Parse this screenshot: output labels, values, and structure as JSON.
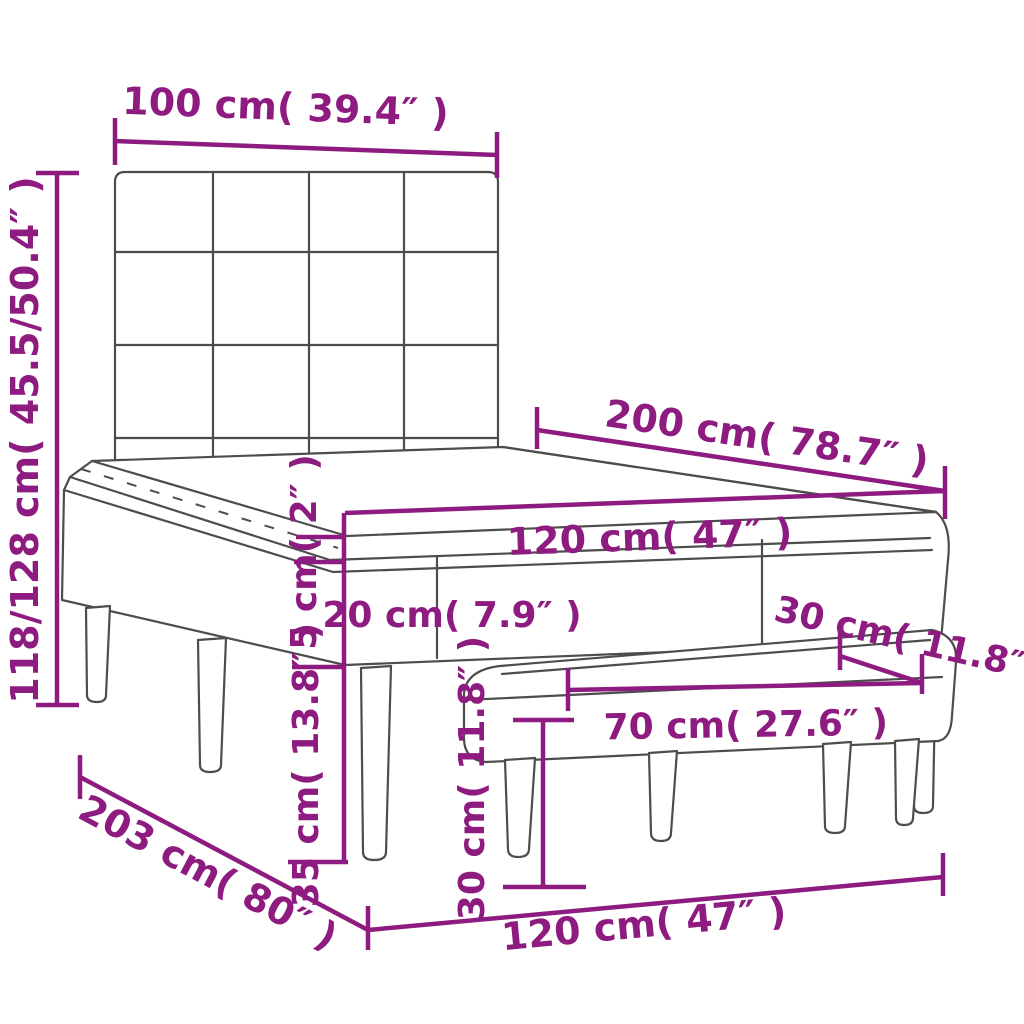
{
  "diagram": {
    "description": "Box spring bed with tufted headboard, mattress topper and matching bench — dimension diagram",
    "colors": {
      "accent": "#8e1b80",
      "line_art": "#4d4d4d",
      "background": "#ffffff"
    },
    "labels": {
      "headboard_width": "100 cm( 39.4″ )",
      "bed_height": "118/128 cm( 45.5/50.4″ )",
      "bed_length": "200 cm( 78.7″ )",
      "mattress_width": "120 cm( 47″ )",
      "topper_thickness": "5 cm( 2″ )",
      "mattress_thickness": "20 cm( 7.9″ )",
      "bench_seat_depth": "30 cm( 11.8″ )",
      "bench_seat_length": "70 cm( 27.6″ )",
      "bed_leg_height": "35 cm( 13.8″ )",
      "bench_height": "30 cm( 11.8″ )",
      "floor_diagonal_length": "203 cm( 80″ )",
      "floor_width": "120 cm( 47″ )"
    },
    "measurements": [
      {
        "part": "headboard width",
        "cm": "100",
        "inches": "39.4"
      },
      {
        "part": "bed height",
        "cm": "118/128",
        "inches": "45.5/50.4"
      },
      {
        "part": "bed length",
        "cm": "200",
        "inches": "78.7"
      },
      {
        "part": "bed width (mattress)",
        "cm": "120",
        "inches": "47"
      },
      {
        "part": "topper thickness",
        "cm": "5",
        "inches": "2"
      },
      {
        "part": "mattress box thickness",
        "cm": "20",
        "inches": "7.9"
      },
      {
        "part": "bench seat depth",
        "cm": "30",
        "inches": "11.8"
      },
      {
        "part": "bench seat length",
        "cm": "70",
        "inches": "27.6"
      },
      {
        "part": "bed leg height",
        "cm": "35",
        "inches": "13.8"
      },
      {
        "part": "bench height",
        "cm": "30",
        "inches": "11.8"
      },
      {
        "part": "bed length at floor",
        "cm": "203",
        "inches": "80"
      },
      {
        "part": "bed width at floor",
        "cm": "120",
        "inches": "47"
      }
    ]
  }
}
